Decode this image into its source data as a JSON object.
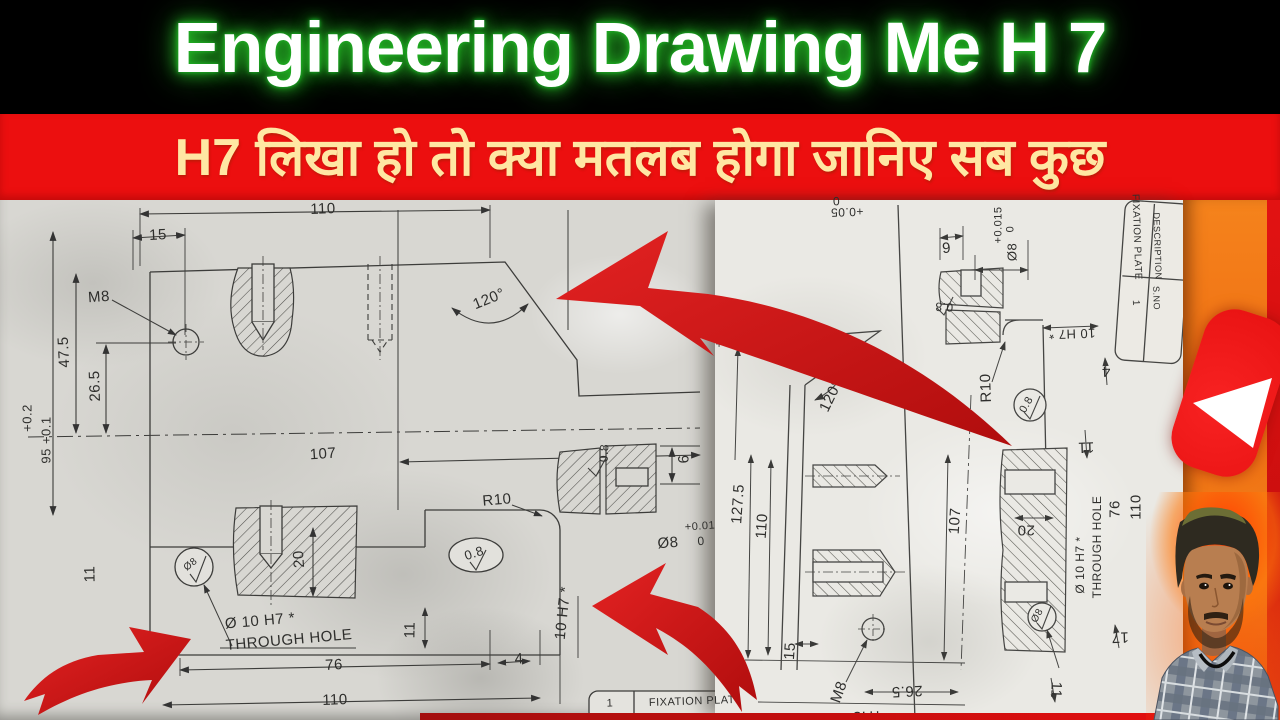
{
  "title_bar": {
    "title": "Engineering Drawing Me H 7"
  },
  "subtitle_bar": {
    "text": "H7 लिखा हो तो क्या मतलब होगा जानिए सब कुछ"
  },
  "colors": {
    "bg_black": "#000000",
    "title_glow": "#2fdc2f",
    "banner_bg": "#ec0f0f",
    "banner_text": "#ffe7a3",
    "paper_left": "#d8d7d2",
    "paper_right": "#eae9e4",
    "line_color": "#3c3c3a",
    "arrow_red": "#cf1414",
    "youtube_orange": "#f07c18",
    "youtube_red": "#e81212"
  },
  "left_drawing": {
    "name": "fixation plate drawing",
    "labels": [
      {
        "t": "110",
        "x": 323,
        "y": 209,
        "r": -2
      },
      {
        "t": "15",
        "x": 158,
        "y": 235,
        "r": -3
      },
      {
        "t": "M8",
        "x": 99,
        "y": 297,
        "r": -4
      },
      {
        "t": "47.5",
        "x": 64,
        "y": 352,
        "r": -93
      },
      {
        "t": "26.5",
        "x": 95,
        "y": 386,
        "r": -92
      },
      {
        "t": "+0.2",
        "x": 27,
        "y": 418,
        "r": -90,
        "s": 13
      },
      {
        "t": "95 +0.1",
        "x": 46,
        "y": 440,
        "r": -90,
        "s": 13
      },
      {
        "t": "107",
        "x": 323,
        "y": 454,
        "r": -4
      },
      {
        "t": "120°",
        "x": 489,
        "y": 299,
        "r": -22
      },
      {
        "t": "R10",
        "x": 497,
        "y": 500,
        "r": -5
      },
      {
        "t": "0.8",
        "x": 474,
        "y": 553,
        "r": -18,
        "s": 13
      },
      {
        "t": "20",
        "x": 299,
        "y": 559,
        "r": -94
      },
      {
        "t": "11",
        "x": 90,
        "y": 574,
        "r": -91
      },
      {
        "t": "Ø8",
        "x": 191,
        "y": 565,
        "r": -38,
        "s": 10
      },
      {
        "t": "Ø 10 H7 *",
        "x": 260,
        "y": 621,
        "r": -5
      },
      {
        "t": "THROUGH HOLE",
        "x": 289,
        "y": 640,
        "r": -5
      },
      {
        "t": "76",
        "x": 334,
        "y": 665,
        "r": -3
      },
      {
        "t": "110",
        "x": 335,
        "y": 700,
        "r": -2
      },
      {
        "t": "11",
        "x": 410,
        "y": 630,
        "r": -89
      },
      {
        "t": "4",
        "x": 519,
        "y": 659,
        "r": -3
      },
      {
        "t": "10 H7 *",
        "x": 563,
        "y": 613,
        "r": -84
      },
      {
        "t": "0.8",
        "x": 604,
        "y": 453,
        "r": -88,
        "s": 12
      },
      {
        "t": "6",
        "x": 684,
        "y": 459,
        "r": -92
      },
      {
        "t": "+0.01",
        "x": 700,
        "y": 527,
        "r": -4,
        "s": 11
      },
      {
        "t": "Ø8",
        "x": 668,
        "y": 543,
        "r": -4
      },
      {
        "t": "0",
        "x": 701,
        "y": 541,
        "r": -4,
        "s": 12
      },
      {
        "t": "1",
        "x": 610,
        "y": 704,
        "r": -2,
        "s": 11
      },
      {
        "t": "FIXATION PLAT",
        "x": 692,
        "y": 702,
        "r": -2,
        "s": 11
      }
    ]
  },
  "right_drawing": {
    "name": "fixation plate drawing rotated",
    "labels": [
      {
        "t": "0",
        "x": 836,
        "y": 201,
        "r": 178,
        "s": 12
      },
      {
        "t": "+0.05",
        "x": 847,
        "y": 212,
        "r": 178,
        "s": 12
      },
      {
        "t": "+0.05",
        "x": 719,
        "y": 331,
        "r": -90,
        "s": 12
      },
      {
        "t": "6",
        "x": 946,
        "y": 247,
        "r": 176
      },
      {
        "t": "0.8",
        "x": 944,
        "y": 307,
        "r": 182,
        "s": 12
      },
      {
        "t": "120°",
        "x": 831,
        "y": 396,
        "r": -64
      },
      {
        "t": "R10",
        "x": 986,
        "y": 388,
        "r": -92
      },
      {
        "t": "+0.015",
        "x": 999,
        "y": 225,
        "r": -90,
        "s": 11
      },
      {
        "t": "0",
        "x": 1011,
        "y": 229,
        "r": -90,
        "s": 11
      },
      {
        "t": "Ø8",
        "x": 1012,
        "y": 252,
        "r": -90,
        "s": 13
      },
      {
        "t": "10 H7 *",
        "x": 1072,
        "y": 334,
        "r": 178,
        "s": 13
      },
      {
        "t": "0.8",
        "x": 1027,
        "y": 405,
        "r": -60,
        "s": 11
      },
      {
        "t": "4",
        "x": 1106,
        "y": 371,
        "r": 178
      },
      {
        "t": "11",
        "x": 1086,
        "y": 447,
        "r": 178
      },
      {
        "t": "127.5",
        "x": 738,
        "y": 504,
        "r": -86
      },
      {
        "t": "110",
        "x": 762,
        "y": 526,
        "r": -86
      },
      {
        "t": "107",
        "x": 955,
        "y": 521,
        "r": -86
      },
      {
        "t": "15",
        "x": 790,
        "y": 651,
        "r": -86
      },
      {
        "t": "M8",
        "x": 839,
        "y": 692,
        "r": -70
      },
      {
        "t": "26.5",
        "x": 907,
        "y": 691,
        "r": 177
      },
      {
        "t": "47.5",
        "x": 868,
        "y": 716,
        "r": 178
      },
      {
        "t": "20",
        "x": 1026,
        "y": 530,
        "r": 180
      },
      {
        "t": "Ø 10 H7 *",
        "x": 1080,
        "y": 565,
        "r": -90,
        "s": 12
      },
      {
        "t": "THROUGH HOLE",
        "x": 1097,
        "y": 547,
        "r": -90,
        "s": 12
      },
      {
        "t": "76",
        "x": 1115,
        "y": 509,
        "r": -90
      },
      {
        "t": "110",
        "x": 1136,
        "y": 507,
        "r": -90
      },
      {
        "t": "17",
        "x": 1120,
        "y": 637,
        "r": 178
      },
      {
        "t": "Ø8",
        "x": 1038,
        "y": 616,
        "r": -60,
        "s": 10
      },
      {
        "t": "11",
        "x": 1056,
        "y": 690,
        "r": 92
      },
      {
        "t": "FIXATION PLATE",
        "x": 1136,
        "y": 237,
        "r": 88,
        "s": 10
      },
      {
        "t": "DESCRIPTION",
        "x": 1157,
        "y": 246,
        "r": 88,
        "s": 9
      },
      {
        "t": "1",
        "x": 1135,
        "y": 303,
        "r": 88,
        "s": 10
      },
      {
        "t": "S.NO",
        "x": 1156,
        "y": 298,
        "r": 88,
        "s": 9
      }
    ]
  }
}
